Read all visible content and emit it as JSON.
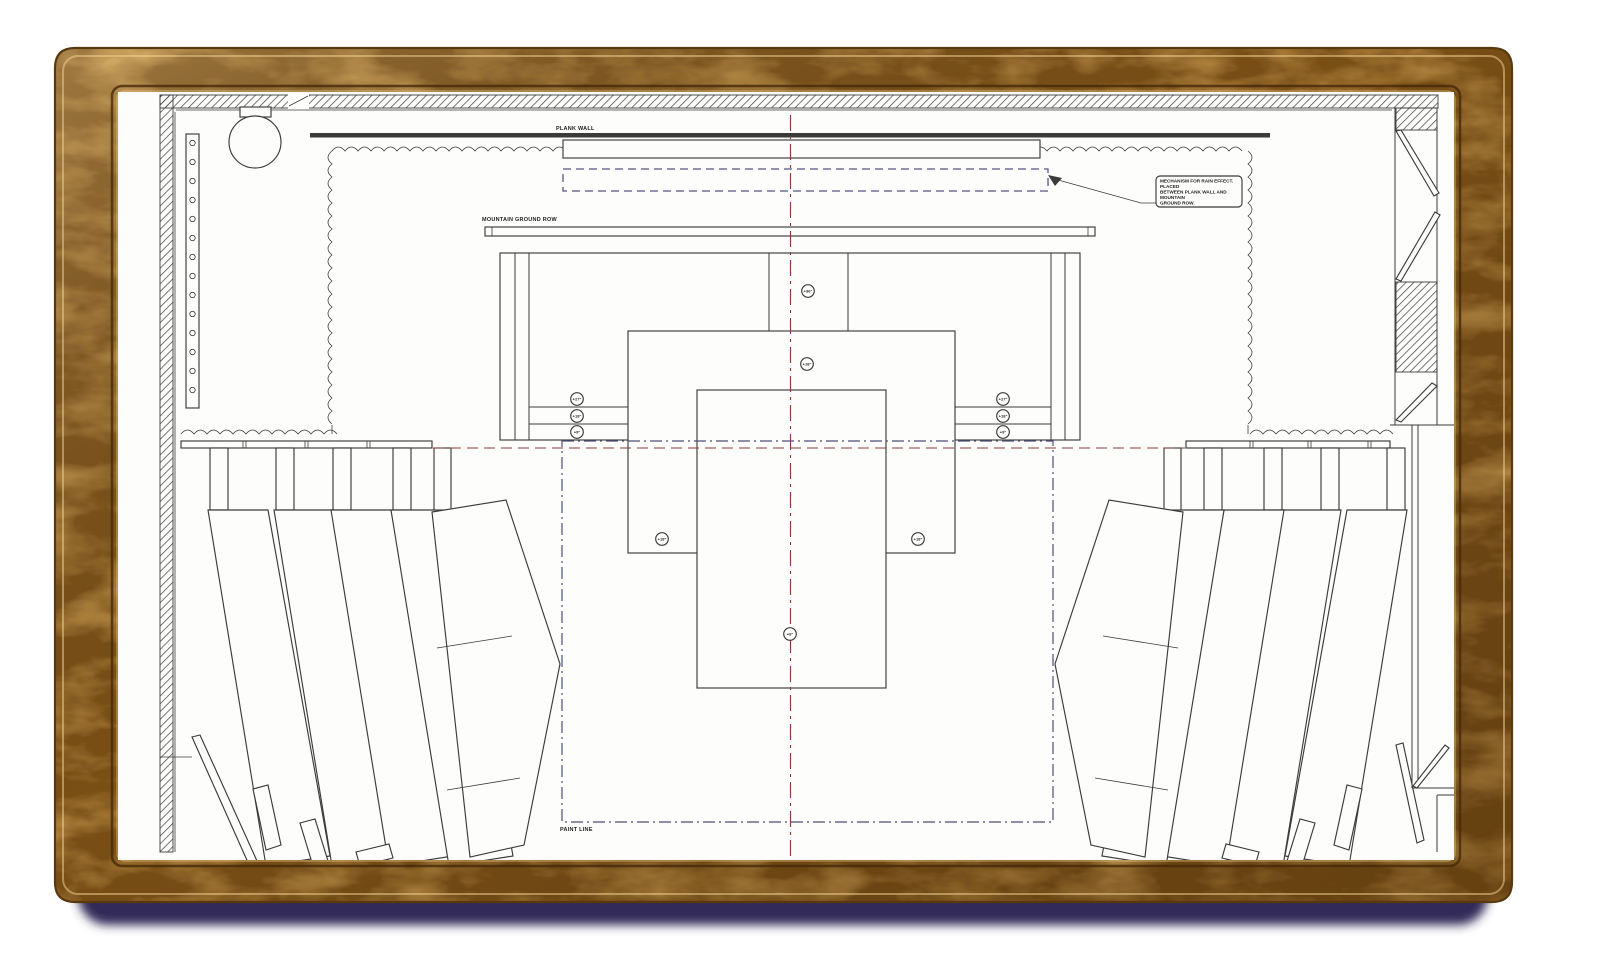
{
  "frame": {
    "wood_base": "#b98a43",
    "wood_dark_streak": "#7a4f16",
    "wood_light_streak": "#e6bd72",
    "shadow_color": "#322c59"
  },
  "plan": {
    "labels": {
      "plank_wall": "PLANK WALL",
      "mountain_ground_row": "MOUNTAIN GROUND ROW",
      "paint_line": "PAINT LINE"
    },
    "rain_note_lines": [
      "MECHANISM FOR RAIN EFFECT.",
      "PLACED",
      "BETWEEN PLANK WALL AND",
      "MOUNTAIN",
      "GROUND ROW."
    ],
    "elevation_markers": [
      {
        "name": "center-bay",
        "value": "+36\""
      },
      {
        "name": "middle-platform-centerline",
        "value": "+18\""
      },
      {
        "name": "rear-steps-left-top",
        "value": "+27\""
      },
      {
        "name": "rear-steps-left-mid",
        "value": "+18\""
      },
      {
        "name": "rear-steps-left-low",
        "value": "+9\""
      },
      {
        "name": "rear-steps-right-top",
        "value": "+27\""
      },
      {
        "name": "rear-steps-right-mid",
        "value": "+18\""
      },
      {
        "name": "rear-steps-right-low",
        "value": "+9\""
      },
      {
        "name": "middle-platform-left",
        "value": "+18\""
      },
      {
        "name": "middle-platform-right",
        "value": "+18\""
      },
      {
        "name": "front-platform",
        "value": "+9\""
      }
    ],
    "colors": {
      "ink": "#3b3b3b",
      "centerline_red": "#8e3c38",
      "paint_line_navy": "#4e4e78",
      "rain_dash_navy": "#565682",
      "paper": "#fdfdfc"
    }
  }
}
